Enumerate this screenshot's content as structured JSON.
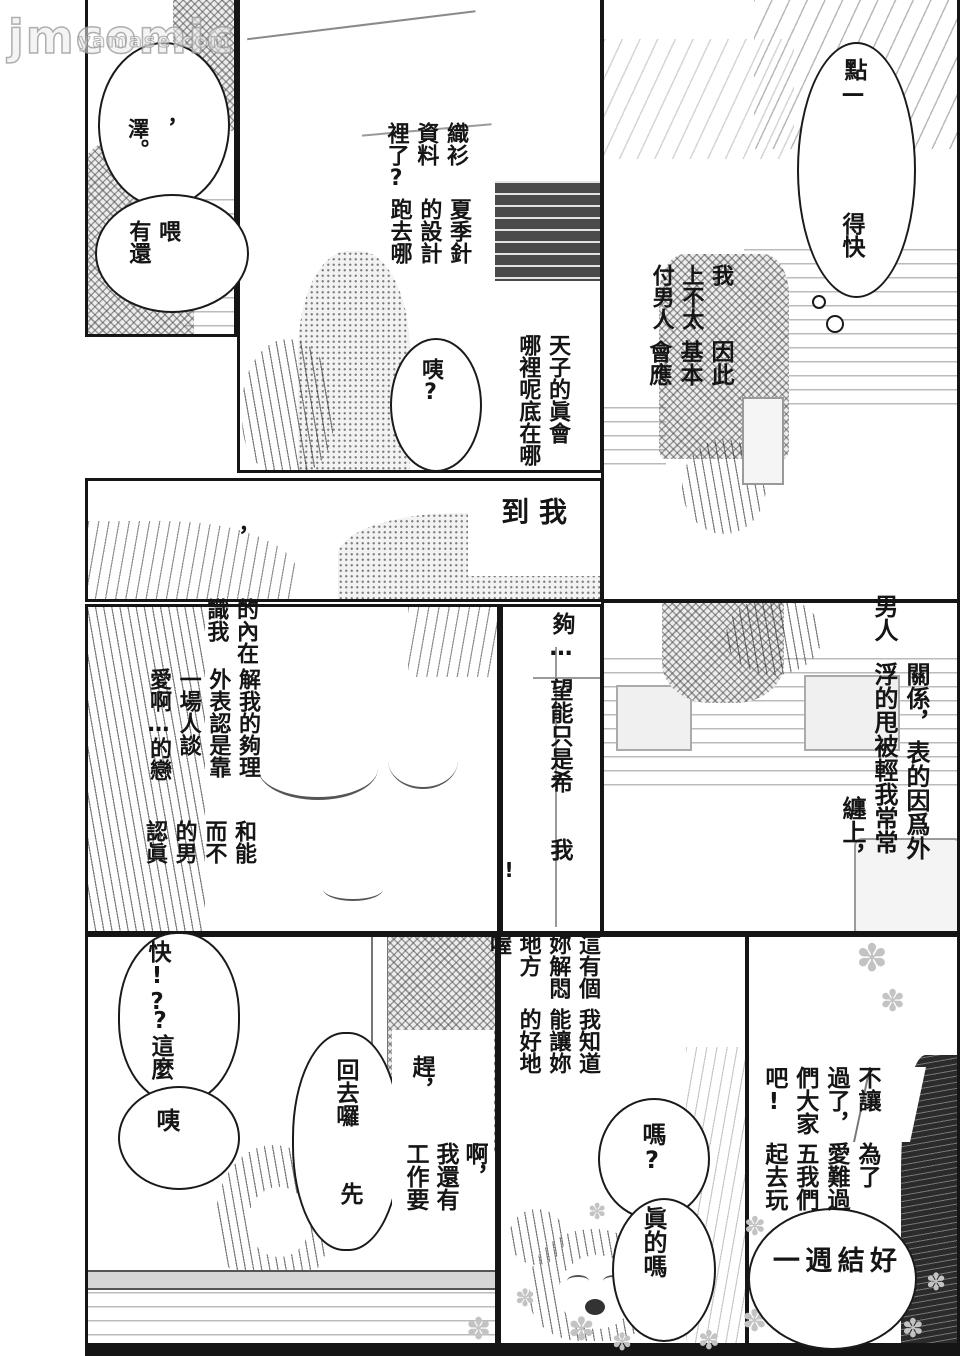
{
  "colors": {
    "ink": "#151515",
    "paper": "#ffffff",
    "tone_gray": "#9a9a9a",
    "watermark_gray": "#bdbdbd"
  },
  "watermark": {
    "main": "jmcomic",
    "sub": "yamase.com"
  },
  "glyphs": {
    "flower": "✽"
  },
  "texts": {
    "b_zawa": "，\n澤。",
    "b_wei": "喂\n有還",
    "knit_r1": "織衫\n資料\n裡了?",
    "knit_r2": "夏季針\n的設計\n跑去哪",
    "b_huh_top": "咦?",
    "where_block": "天子的眞會\n哪裡呢底在哪",
    "b_dot": "點—",
    "b_dekuai": "得快",
    "cope_r1": "我\n上不太\n付男人",
    "cope_r2": "因此\n基本\n會應",
    "comma_lone": "，",
    "b_daowo": "我\n到",
    "inner_r1": "的內在\n識我",
    "inner_r2": "解我的夠理\n外表認是靠\n一場人談\n愛啊…的戀",
    "inner_r3": "和能\n而不\n的男\n認眞",
    "t_gou": "夠…",
    "t_hope": "望能只是希",
    "t_wo": "我",
    "t_excl": "!",
    "t_nanren": "男人",
    "t_guanxi": "關係，",
    "t_biao": "表的因爲外",
    "t_fu": "浮的甩被輕我常常",
    "t_chan": "纏上，",
    "b_kuai": "快!?",
    "b_zheme": "?這麼",
    "b_yi": "咦",
    "t_huiqu": "回去囉",
    "t_xian": "先",
    "t_gan": "趕，",
    "t_a": "啊，",
    "t_haiyou": "我還有",
    "t_gongzuo": "工作要",
    "place_r1": "這有個\n妳解悶\n地方喔!",
    "place_r2": "我知道\n能讓妳\n的好地",
    "b_ma": "嗎?",
    "t_zhendema": "眞的嗎",
    "invite_r1": "不讓\n過了，\n們大家\n吧!",
    "invite_r2": "為了\n愛難過\n五我們\n起去玩",
    "b_ok": "好\n結\n週\n一"
  }
}
